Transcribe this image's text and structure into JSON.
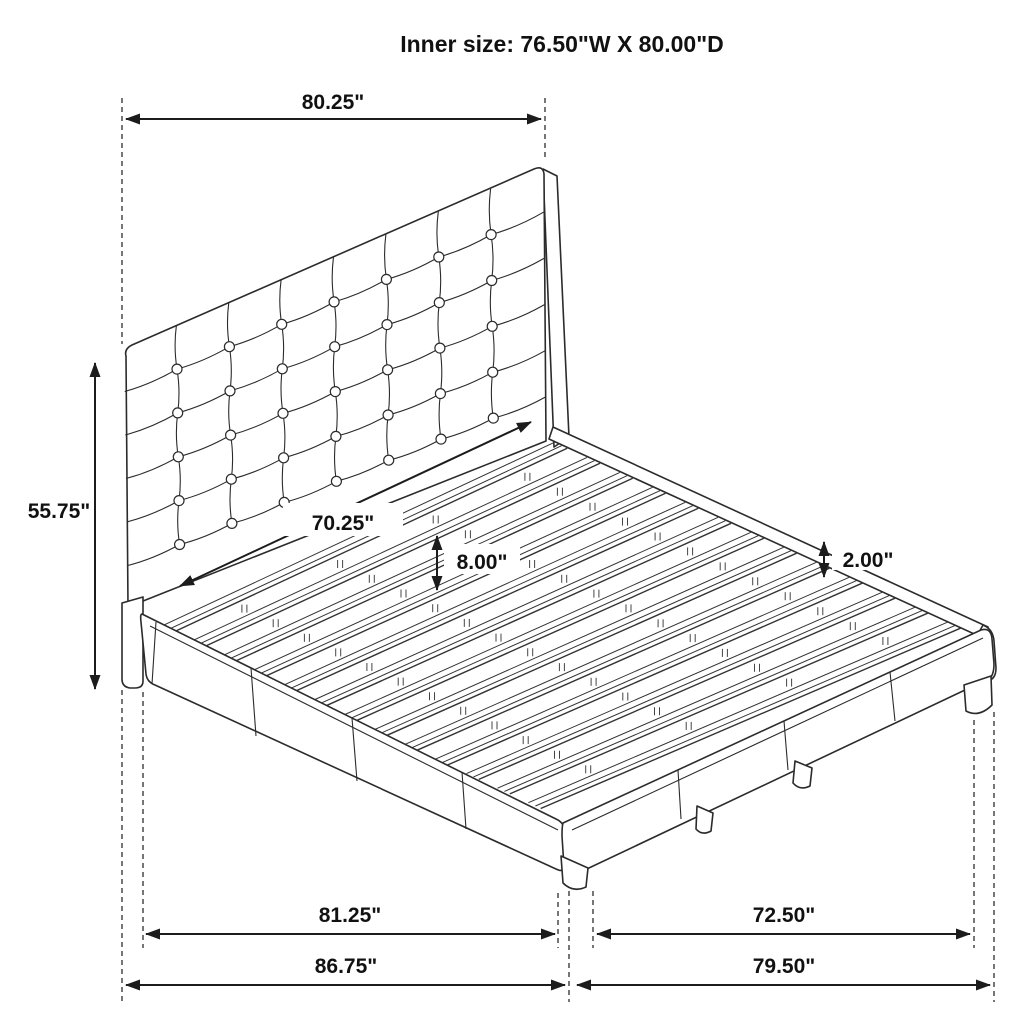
{
  "title": "Inner size: 76.50\"W X 80.00\"D",
  "dimensions": {
    "headboard_width": "80.25\"",
    "headboard_height": "55.75\"",
    "inner_headboard_width": "70.25\"",
    "slat_spacing": "8.00\"",
    "side_rail_lip_height": "2.00\"",
    "side_rail_length": "81.25\"",
    "overall_depth": "86.75\"",
    "footboard_inner_width": "72.50\"",
    "overall_width": "79.50\""
  },
  "colors": {
    "line": "#2b2b2b",
    "dimension": "#1c1c1c",
    "text": "#111111",
    "background": "#ffffff"
  },
  "icons": {
    "arrows": "double-headed-dimension-arrow"
  }
}
